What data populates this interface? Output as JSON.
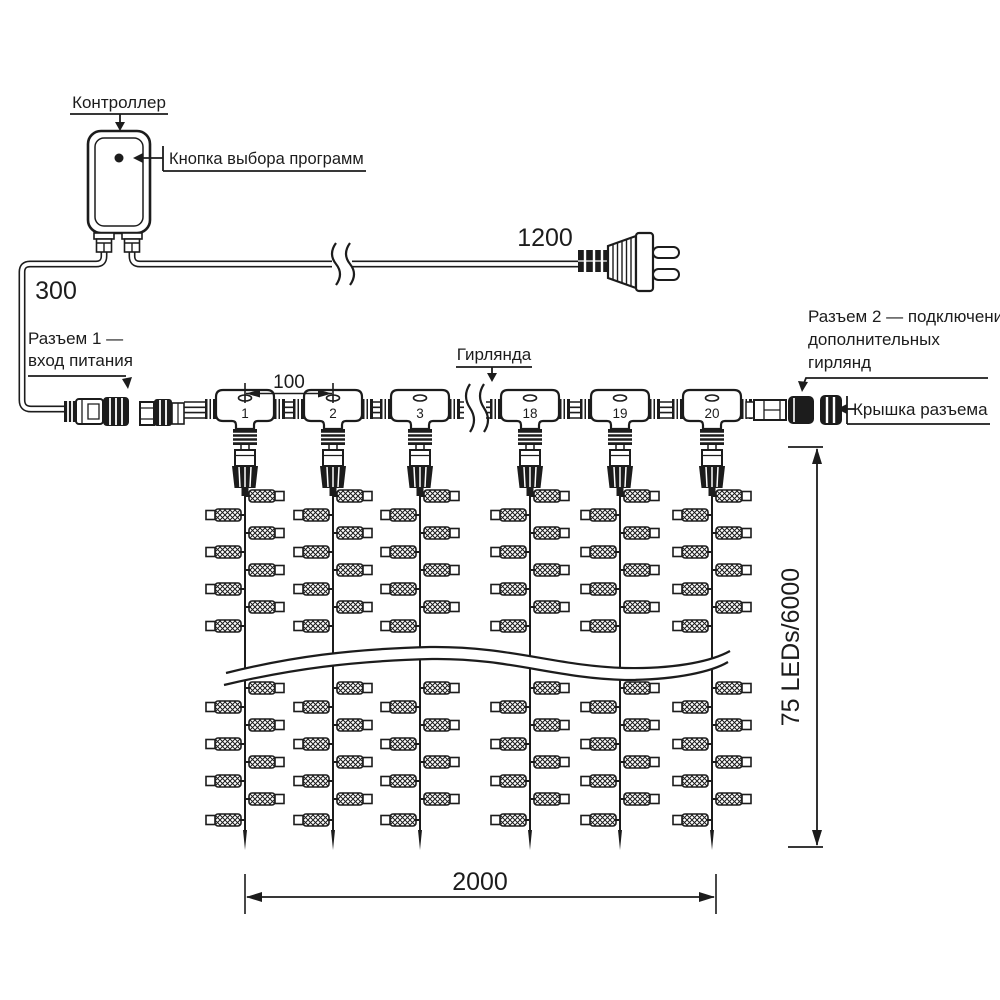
{
  "diagram": {
    "controller_label": "Контроллер",
    "button_label": "Кнопка выбора программ",
    "cord_length": "1200",
    "lead_length": "300",
    "connector1": {
      "line1": "Разъем 1 —",
      "line2": "вход питания"
    },
    "garland_label": "Гирлянда",
    "connector2": {
      "line1": "Разъем 2 — подключение",
      "line2": "дополнительных",
      "line3": "гирлянд"
    },
    "cap_label": "Крышка разъема",
    "drop_spacing": "100",
    "width_dim": "2000",
    "height_dim": "75 LEDs/6000",
    "drops": [
      "1",
      "2",
      "3",
      "18",
      "19",
      "20"
    ]
  },
  "colors": {
    "ink": "#1c1c1c",
    "background": "#ffffff"
  }
}
